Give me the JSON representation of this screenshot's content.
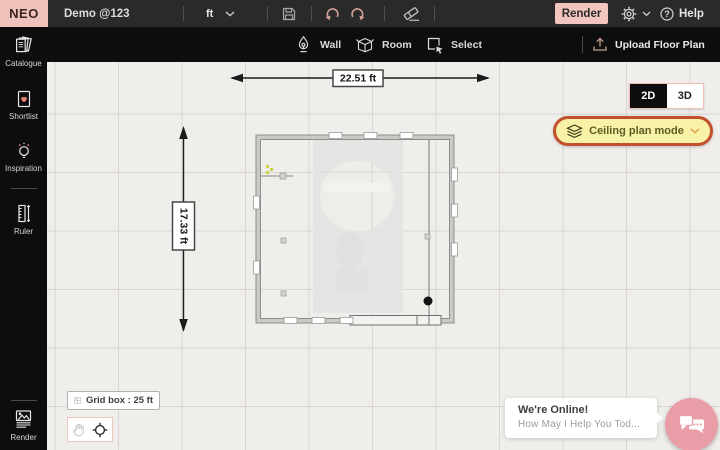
{
  "topbar": {
    "logo": "NEO",
    "doc_title": "Demo @123",
    "unit": "ft",
    "render_label": "Render",
    "help_label": "Help",
    "help_glyph": "?"
  },
  "toolbar": {
    "wall_label": "Wall",
    "room_label": "Room",
    "select_label": "Select",
    "upload_label": "Upload Floor Plan"
  },
  "sidebar": {
    "items": [
      {
        "label": "Catalogue",
        "icon": "catalogue-icon"
      },
      {
        "label": "Shortlist",
        "icon": "shortlist-icon"
      },
      {
        "label": "Inspiration",
        "icon": "inspiration-icon"
      },
      {
        "label": "Ruler",
        "icon": "ruler-icon"
      },
      {
        "label": "Render",
        "icon": "render-image-icon"
      }
    ]
  },
  "canvas": {
    "dim_width_label": "22.51 ft",
    "dim_height_label": "17.33 ft",
    "grid_box_label": "Grid box : 25 ft",
    "view_2d_label": "2D",
    "view_3d_label": "3D",
    "view_selected": "2D",
    "ceiling_mode_label": "Ceiling plan mode"
  },
  "chat": {
    "title": "We're Online!",
    "subtitle": "How May I Help You Tod..."
  },
  "colors": {
    "accent_pink": "#f2c5be",
    "logo_pink": "#efc3bc",
    "highlight_border": "#c2502e",
    "highlight_bg": "#f7f2a5",
    "chat_button_pink": "#e99da7",
    "heart_red": "#e4827c",
    "canvas_bg": "#efeeeb",
    "grid_line": "#d9d6d2",
    "topbar_bg": "#2a2a2a",
    "panel_bg": "#0d0d0d"
  },
  "icons": [
    "save-icon",
    "undo-icon",
    "redo-icon",
    "eraser-icon",
    "gear-icon",
    "help-icon",
    "wall-icon",
    "room-icon",
    "select-icon",
    "upload-icon",
    "layers-icon",
    "grid-icon",
    "hand-icon",
    "locate-icon",
    "chat-bubbles-icon",
    "chevron-down-icon"
  ]
}
